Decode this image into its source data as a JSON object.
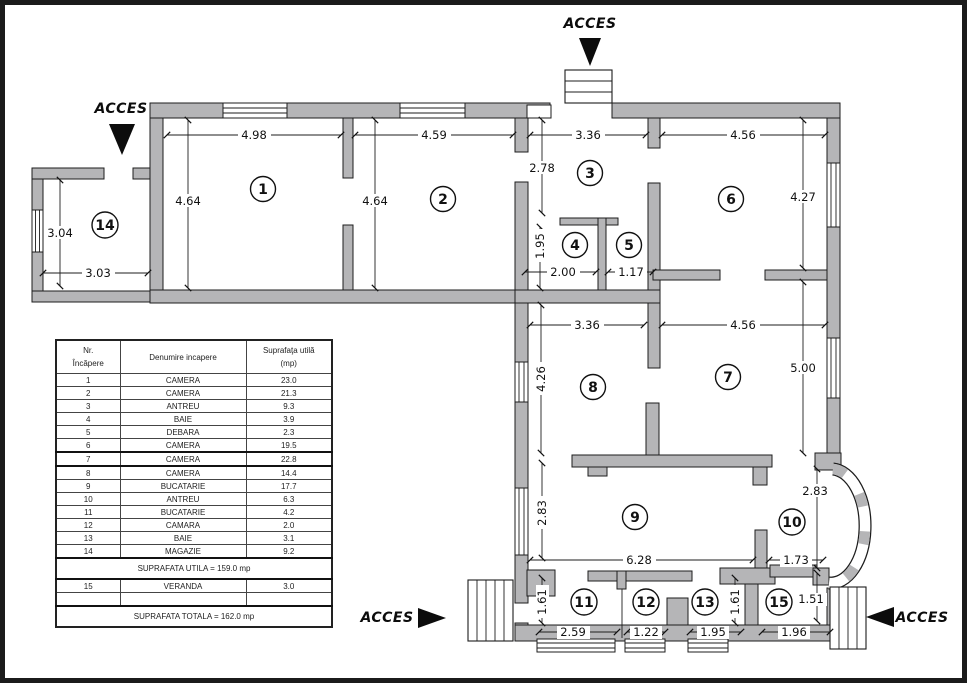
{
  "floorplan": {
    "access_label": "ACCES",
    "rooms": [
      "1",
      "2",
      "3",
      "4",
      "5",
      "6",
      "7",
      "8",
      "9",
      "10",
      "11",
      "12",
      "13",
      "14",
      "15"
    ],
    "dims": {
      "room1_w": "4.98",
      "room1_h": "4.64",
      "room2_w": "4.59",
      "room2_h": "4.64",
      "room3_w": "3.36",
      "room3_h": "2.78",
      "room4_w": "2.00",
      "room4_h": "1.95",
      "room5_w": "1.17",
      "room6_w": "4.56",
      "room6_h": "4.27",
      "room7_w": "4.56",
      "room7_h": "5.00",
      "room8_w": "3.36",
      "room8_h": "4.26",
      "room9_w": "6.28",
      "room9_h": "2.83",
      "room10_w": "1.73",
      "room10_h": "2.83",
      "room11_w": "2.59",
      "room11_h": "1.61",
      "room12_w": "1.22",
      "room13_w": "1.95",
      "room13_h": "1.61",
      "room14_w": "3.03",
      "room14_h": "3.04",
      "room15_w": "1.96",
      "room15_h": "1.51"
    }
  },
  "table": {
    "headers": {
      "col1_line1": "Nr.",
      "col1_line2": "Încăpere",
      "col2": "Denumire incapere",
      "col3_line1": "Suprafaţa utilă",
      "col3_line2": "(mp)"
    },
    "rows": [
      [
        "1",
        "CAMERA",
        "23.0"
      ],
      [
        "2",
        "CAMERA",
        "21.3"
      ],
      [
        "3",
        "ANTREU",
        "9.3"
      ],
      [
        "4",
        "BAIE",
        "3.9"
      ],
      [
        "5",
        "DEBARA",
        "2.3"
      ],
      [
        "6",
        "CAMERA",
        "19.5"
      ],
      [
        "7",
        "CAMERA",
        "22.8"
      ],
      [
        "8",
        "CAMERA",
        "14.4"
      ],
      [
        "9",
        "BUCATARIE",
        "17.7"
      ],
      [
        "10",
        "ANTREU",
        "6.3"
      ],
      [
        "11",
        "BUCATARIE",
        "4.2"
      ],
      [
        "12",
        "CAMARA",
        "2.0"
      ],
      [
        "13",
        "BAIE",
        "3.1"
      ],
      [
        "14",
        "MAGAZIE",
        "9.2"
      ]
    ],
    "subtotal": "SUPRAFATA UTILA = 159.0 mp",
    "veranda_row": [
      "15",
      "VERANDA",
      "3.0"
    ],
    "total": "SUPRAFATA TOTALA = 162.0 mp"
  }
}
